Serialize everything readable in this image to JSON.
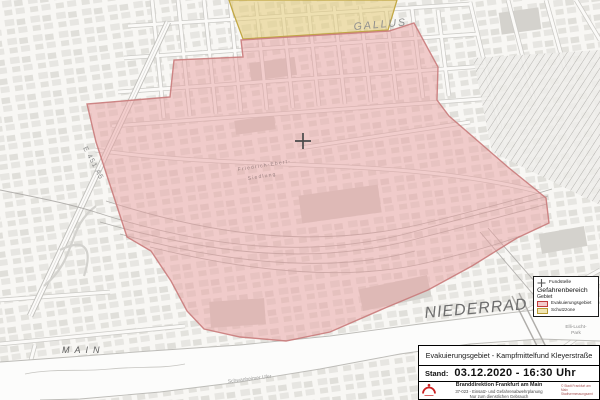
{
  "map": {
    "labels": {
      "district_north": "GALLUS",
      "district_south": "NIEDERRAD",
      "river": "MAIN",
      "highway": "E 451 A5",
      "settlement_line1": "Friedrich-Ebert-",
      "settlement_line2": "Siedlung",
      "park_line1": "Elli-Lucht-",
      "park_line2": "Park",
      "riverside_street": "Schwanheimer Ufer"
    },
    "zones": {
      "evacuation": {
        "name": "Evakuierungsgebiet",
        "fill": "#e89f9f",
        "border": "#c97b7b"
      },
      "protection": {
        "name": "Schutzzone",
        "fill": "#e3cb76",
        "border": "#c2a845"
      }
    }
  },
  "legend": {
    "fundstelle_label": "Fundstelle",
    "section_title": "Gefahrenbereich",
    "subsection_title": "Gebiet",
    "items": [
      {
        "label": "Evakuierungsgebiet",
        "fill": "#f4cbcb",
        "border": "#c23b3b"
      },
      {
        "label": "Schutzzone",
        "fill": "#f1e6b4",
        "border": "#b99c35"
      }
    ]
  },
  "title_block": {
    "title": "Evakuierungsgebiet - Kampfmittelfund Kleyerstraße",
    "stand_label": "Stand:",
    "stand_value": "03.12.2020 - 16:30 Uhr",
    "org_name": "Branddirektion Frankfurt am Main",
    "org_dept": "37-023  - Einsatz- und Gefahrenabwehrplanung",
    "org_note": "Nur zum dienstlichen Gebrauch",
    "copyright_line1": "© Stadt Frankfurt am Main",
    "copyright_line2": "Stadtvermessungsamt"
  }
}
